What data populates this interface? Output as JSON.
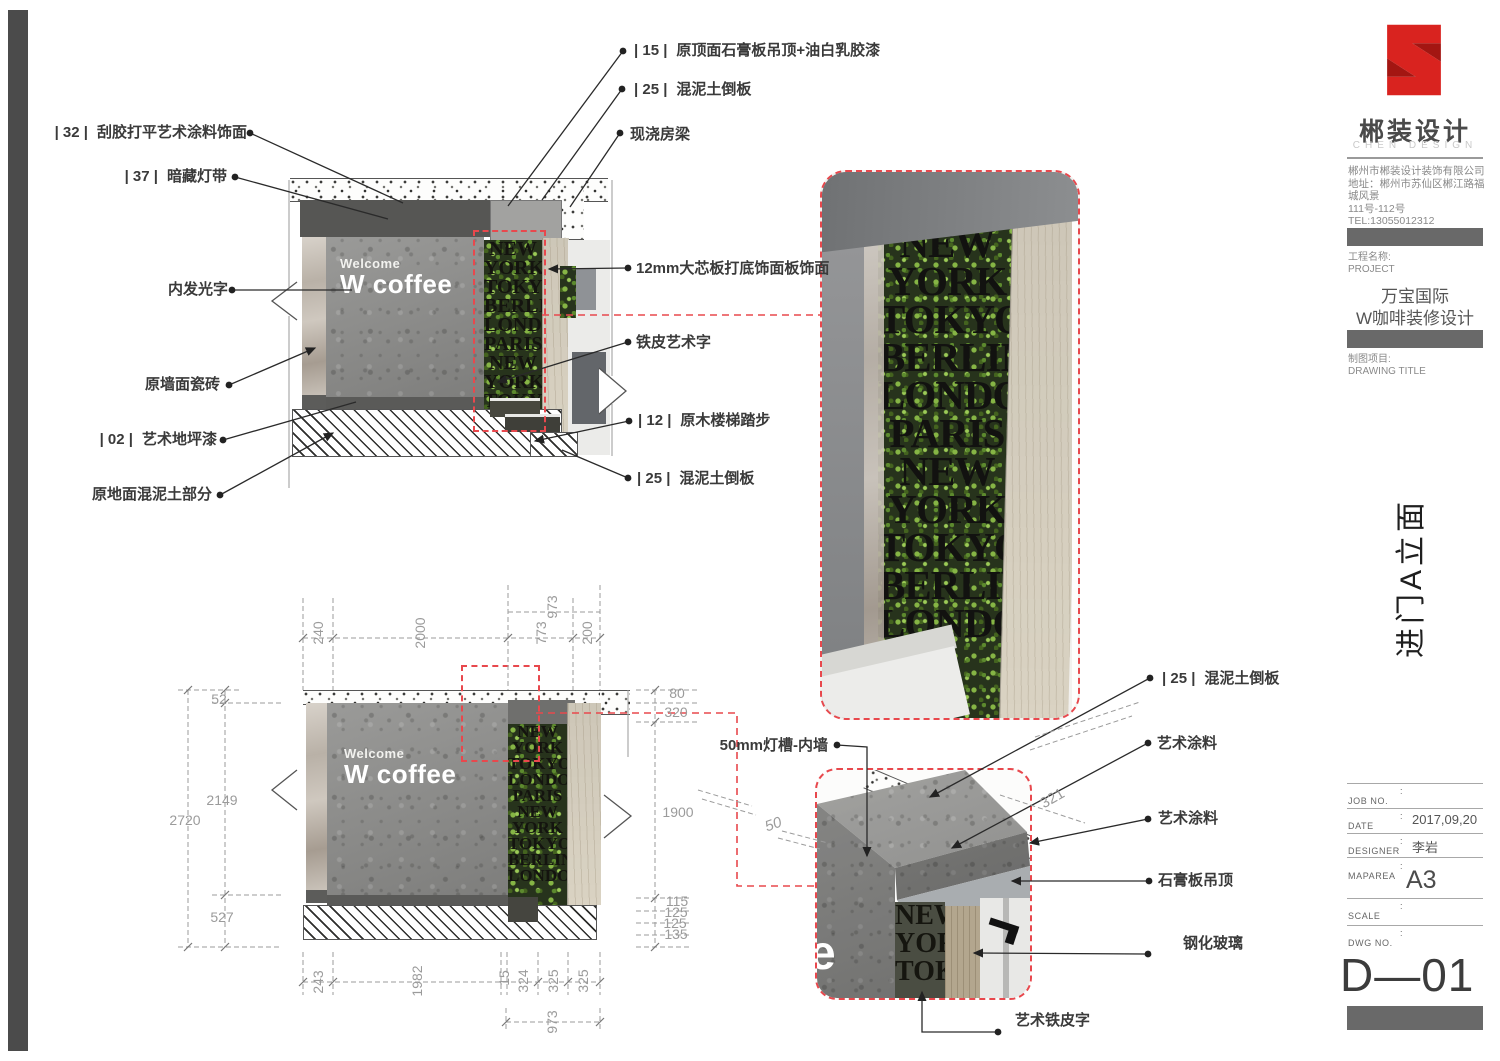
{
  "colors": {
    "accent_red": "#d9231f",
    "red_dash": "#e8484d",
    "dim_gray": "#9b9b9b"
  },
  "elevation_top": {
    "sign": {
      "line1": "Welcome",
      "line2": "W coffee"
    },
    "screen_words": [
      "NEW",
      "YORK",
      "TOKYO",
      "BERLIN",
      "LONDON",
      "PARIS",
      "NEW",
      "YORK",
      "TOKYO",
      "BERLIN"
    ],
    "callouts_left": [
      {
        "code": "| 32 |",
        "text": "刮胶打平艺术涂料饰面"
      },
      {
        "code": "| 37 |",
        "text": "暗藏灯带"
      },
      {
        "code": "",
        "text": "内发光字"
      },
      {
        "code": "",
        "text": "原墙面瓷砖"
      },
      {
        "code": "| 02 |",
        "text": "艺术地坪漆"
      },
      {
        "code": "",
        "text": "原地面混泥土部分"
      }
    ],
    "callouts_topright": [
      {
        "code": "| 15 |",
        "text": "原顶面石膏板吊顶+油白乳胶漆"
      },
      {
        "code": "| 25 |",
        "text": "混泥土倒板"
      },
      {
        "code": "",
        "text": "现浇房梁"
      }
    ],
    "callouts_right": [
      {
        "code": "",
        "text": "12mm大芯板打底饰面板饰面"
      },
      {
        "code": "",
        "text": "铁皮艺术字"
      },
      {
        "code": "| 12 |",
        "text": "原木楼梯踏步"
      },
      {
        "code": "| 25 |",
        "text": "混泥土倒板"
      }
    ]
  },
  "elevation_bottom": {
    "sign": {
      "line1": "Welcome",
      "line2": "W coffee"
    },
    "screen_words": [
      "NEW",
      "YORK",
      "TOKYO",
      "LONDON",
      "PARIS",
      "NEW",
      "YORK",
      "TOKYO",
      "BERLIN",
      "LONDON"
    ],
    "dims": {
      "top": [
        "240",
        "2000",
        "773",
        "973",
        "200"
      ],
      "left": [
        "52",
        "2149",
        "2720",
        "527"
      ],
      "right": [
        "80",
        "320",
        "1900"
      ],
      "right_stack": [
        "115",
        "125",
        "125",
        "135"
      ],
      "bottom": [
        "243",
        "1982",
        "15",
        "324",
        "325",
        "325"
      ],
      "bottom2": "973"
    }
  },
  "detail_large": {
    "screen_words": [
      "NEW",
      "YORK",
      "TOKYO",
      "BERLIN",
      "LONDON",
      "PARIS",
      "NEW",
      "YORK",
      "TOKYO",
      "BERLIN",
      "LONDON"
    ]
  },
  "detail_small": {
    "screen_words": [
      "NEW",
      "YORK",
      "TOKYO"
    ],
    "sign_letter": "e",
    "callouts": [
      {
        "code": "| 25 |",
        "text": "混泥土倒板"
      },
      {
        "code": "",
        "text": "艺术涂料"
      },
      {
        "code": "",
        "text": "艺术涂料"
      },
      {
        "code": "",
        "text": "石膏板吊顶"
      },
      {
        "code": "",
        "text": "钢化玻璃"
      },
      {
        "code": "",
        "text": "艺术铁皮字"
      },
      {
        "code": "",
        "text": "50mm灯槽-内墙"
      }
    ],
    "dims": {
      "d50": "50",
      "d321": "321"
    }
  },
  "titleblock": {
    "brand": {
      "name": "郴装设计",
      "name_en": "CHEN DESIGN"
    },
    "company_lines": [
      "郴州市郴装设计装饰有限公司",
      "地址：郴州市苏仙区郴江路福城风景",
      "111号-112号",
      "TEL:13055012312",
      "www.chenzhuang2015.com"
    ],
    "project": {
      "label": "工程名称:",
      "label_en": "PROJECT",
      "name_line1": "万宝国际",
      "name_line2": "W咖啡装修设计"
    },
    "drawing": {
      "label": "制图项目:",
      "label_en": "DRAWING TITLE",
      "title_vertical": "进门A立面"
    },
    "colon": ":",
    "fields": [
      {
        "label": "JOB NO.",
        "value": ""
      },
      {
        "label": "DATE",
        "value": "2017,09,20"
      },
      {
        "label": "DESIGNER",
        "value": "李岩"
      },
      {
        "label": "MAPAREA",
        "value": "A3"
      },
      {
        "label": "SCALE",
        "value": ""
      },
      {
        "label": "DWG NO.",
        "value": ""
      }
    ],
    "dwg_no": "D—01"
  }
}
